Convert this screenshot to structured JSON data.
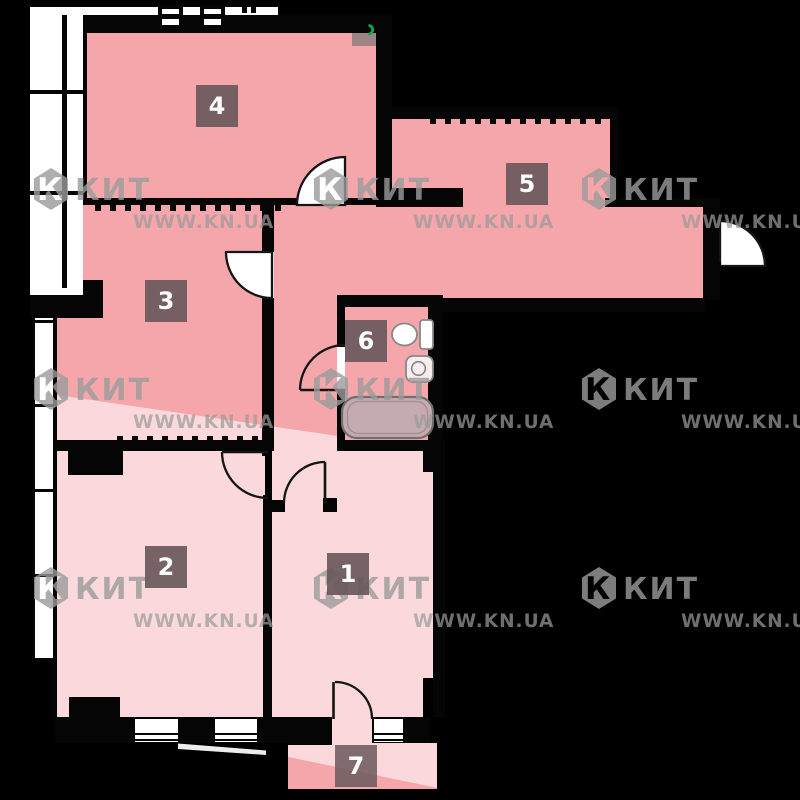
{
  "page": {
    "type": "apartment floor plan",
    "background_color": "#000000"
  },
  "colors": {
    "room_fill_dark": "#F5A6AB",
    "room_fill_light": "#FAD8DB",
    "room_fill_muted": "#9D8487",
    "wall": "#050505",
    "label_bg": "#6E5B5E",
    "label_text": "#FFFFFF",
    "tub_fill": "#C5ABAF",
    "fixture_stroke": "#7E7E7E",
    "accent_green": "#13A45C",
    "watermark_gray": "#9B9B9B"
  },
  "rooms": [
    {
      "number": "1"
    },
    {
      "number": "2"
    },
    {
      "number": "3"
    },
    {
      "number": "4"
    },
    {
      "number": "5"
    },
    {
      "number": "6"
    },
    {
      "number": "7"
    }
  ],
  "watermark": {
    "brand": "КИТ",
    "site": "WWW.KN.UA",
    "positions": [
      {
        "x": 33,
        "y": 168
      },
      {
        "x": 313,
        "y": 168
      },
      {
        "x": 581,
        "y": 168
      },
      {
        "x": 33,
        "y": 368
      },
      {
        "x": 313,
        "y": 368
      },
      {
        "x": 581,
        "y": 368
      },
      {
        "x": 33,
        "y": 567
      },
      {
        "x": 313,
        "y": 567
      },
      {
        "x": 581,
        "y": 567
      }
    ]
  }
}
